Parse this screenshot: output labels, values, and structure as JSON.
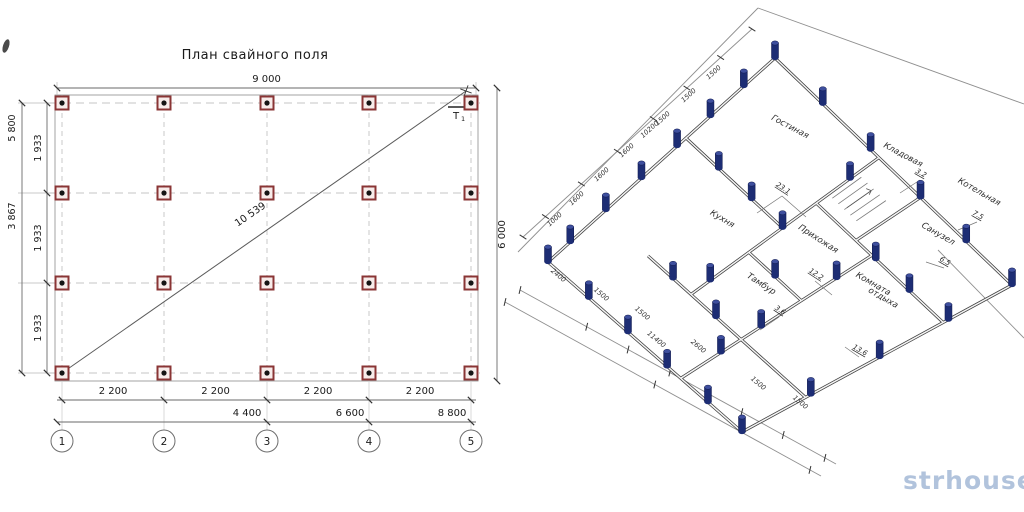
{
  "title": "План свайного поля",
  "watermark": "strhouse.ru",
  "colors": {
    "line": "#4a4a4a",
    "dim": "#6a6a6a",
    "text": "#1a1a1a",
    "dashed": "#c4c4c4",
    "thin": "#9a9a9a",
    "pile_red_border": "#8a3535",
    "pile_red_fill": "#f7ecea",
    "pile_dot": "#141414",
    "pile_navy": "#1d2d74",
    "pile_navy_top": "#3e4f9e",
    "watermark": "#a9bdd9"
  },
  "left": {
    "cols": [
      62,
      164,
      267,
      369,
      471
    ],
    "rows": [
      103,
      193,
      283,
      373
    ],
    "outline": [
      55,
      95,
      478,
      381
    ],
    "top_dim": {
      "y": 88,
      "x1": 57,
      "x2": 476,
      "label": "9 000"
    },
    "right_dim": {
      "x": 497,
      "y1": 88,
      "y2": 381,
      "label": "6 000"
    },
    "left_dim_outer": {
      "x": 22,
      "labels": [
        {
          "t": "5 800",
          "y": 128
        },
        {
          "t": "3 867",
          "y": 216
        }
      ]
    },
    "left_dim_inner": {
      "x": 47,
      "labels": [
        {
          "t": "1 933",
          "y": 148
        },
        {
          "t": "1 933",
          "y": 238
        },
        {
          "t": "1 933",
          "y": 328
        }
      ]
    },
    "diag": {
      "x1": 62,
      "y1": 373,
      "x2": 466,
      "y2": 91,
      "label": "10 539",
      "lx": 252,
      "ly": 217,
      "rot": -34.5
    },
    "bottom1": {
      "y": 400,
      "labels": [
        "2 200",
        "2 200",
        "2 200",
        "2 200"
      ]
    },
    "bottom2": {
      "y": 422,
      "ticks": [
        57,
        267,
        369,
        471
      ],
      "labels": [
        {
          "t": "4 400",
          "x": 247
        },
        {
          "t": "6 600",
          "x": 350
        },
        {
          "t": "8 800",
          "x": 452
        }
      ]
    },
    "axes": {
      "y": 441,
      "r": 11,
      "nums": [
        "1",
        "2",
        "3",
        "4",
        "5"
      ]
    },
    "t1_label": "Т1"
  },
  "right": {
    "corners": {
      "L": [
        548,
        262
      ],
      "T": [
        775,
        58
      ],
      "R": [
        1012,
        285
      ],
      "B": [
        742,
        432
      ]
    },
    "plan_size": [
      10200,
      11400
    ],
    "boundary": [
      [
        518,
        252,
        758,
        8
      ],
      [
        758,
        8,
        1024,
        104
      ],
      [
        938,
        250,
        1024,
        338
      ]
    ],
    "dim_lines": [
      [
        523,
        237,
        752,
        29
      ],
      [
        520,
        290,
        836,
        464
      ],
      [
        505,
        302,
        821,
        476
      ]
    ],
    "ticksA": [
      0,
      0.098,
      0.255,
      0.412,
      0.569,
      0.716,
      0.863,
      1
    ],
    "ticksB": [
      0,
      0.211,
      0.342,
      0.474,
      0.702,
      0.833,
      0.965
    ],
    "walls": [
      [
        0,
        0,
        10200,
        0
      ],
      [
        10200,
        0,
        10200,
        11400
      ],
      [
        10200,
        11400,
        0,
        11400
      ],
      [
        0,
        11400,
        0,
        0
      ],
      [
        6200,
        0,
        6200,
        5000
      ],
      [
        2400,
        5000,
        10200,
        5000
      ],
      [
        2400,
        2600,
        2400,
        7800
      ],
      [
        0,
        7800,
        7600,
        7800
      ],
      [
        7600,
        5000,
        7600,
        11400
      ],
      [
        7600,
        7000,
        10200,
        7000
      ],
      [
        4800,
        5000,
        4800,
        7800
      ],
      [
        2400,
        7800,
        2400,
        11400
      ]
    ],
    "piles": [
      [
        0,
        0
      ],
      [
        1000,
        0
      ],
      [
        2600,
        0
      ],
      [
        4200,
        0
      ],
      [
        5800,
        0
      ],
      [
        7300,
        0
      ],
      [
        8800,
        0
      ],
      [
        10200,
        0
      ],
      [
        10200,
        2300
      ],
      [
        10200,
        4600
      ],
      [
        10200,
        7000
      ],
      [
        10200,
        9200
      ],
      [
        10200,
        11400
      ],
      [
        7800,
        11400
      ],
      [
        5200,
        11400
      ],
      [
        2600,
        11400
      ],
      [
        0,
        11400
      ],
      [
        0,
        2400
      ],
      [
        0,
        4700
      ],
      [
        0,
        7000
      ],
      [
        0,
        9400
      ],
      [
        3200,
        5000
      ],
      [
        6200,
        5000
      ],
      [
        9000,
        5000
      ],
      [
        6200,
        1700
      ],
      [
        6200,
        3400
      ],
      [
        7600,
        8000
      ],
      [
        7600,
        9700
      ],
      [
        1600,
        7800
      ],
      [
        3200,
        7800
      ],
      [
        6200,
        7800
      ],
      [
        2400,
        4000
      ],
      [
        2400,
        6400
      ],
      [
        4800,
        6400
      ]
    ],
    "rooms": [
      {
        "t": "Гостиная",
        "x": 789,
        "y": 129,
        "r": 28
      },
      {
        "t": "Кладовая",
        "x": 902,
        "y": 157,
        "r": 28
      },
      {
        "t": "Котельная",
        "x": 978,
        "y": 194,
        "r": 30
      },
      {
        "t": "Кухня",
        "x": 721,
        "y": 221,
        "r": 31
      },
      {
        "t": "Прихожая",
        "x": 817,
        "y": 241,
        "r": 33
      },
      {
        "t": "Санузел",
        "x": 937,
        "y": 236,
        "r": 30
      },
      {
        "t": "Тамбур",
        "x": 760,
        "y": 286,
        "r": 33
      },
      {
        "t": "Комната",
        "x": 872,
        "y": 286,
        "r": 30
      },
      {
        "t": "отдыха",
        "x": 882,
        "y": 300,
        "r": 30
      }
    ],
    "areas": [
      {
        "t": "23.1",
        "x": 782,
        "y": 190,
        "r": 33
      },
      {
        "t": "3.2",
        "x": 920,
        "y": 175,
        "r": 30
      },
      {
        "t": "7.5",
        "x": 977,
        "y": 217,
        "r": 30
      },
      {
        "t": "6.5",
        "x": 944,
        "y": 263,
        "r": 30
      },
      {
        "t": "12.2",
        "x": 815,
        "y": 276,
        "r": 33
      },
      {
        "t": "3.6",
        "x": 779,
        "y": 312,
        "r": 33
      },
      {
        "t": "13.6",
        "x": 859,
        "y": 352,
        "r": 30
      }
    ],
    "leaders": [
      [
        782,
        196,
        757,
        213
      ],
      [
        782,
        196,
        806,
        217
      ],
      [
        815,
        281,
        832,
        295
      ],
      [
        920,
        180,
        900,
        193
      ],
      [
        977,
        222,
        958,
        230
      ],
      [
        944,
        268,
        926,
        262
      ],
      [
        859,
        357,
        845,
        347
      ],
      [
        779,
        317,
        760,
        330
      ]
    ],
    "dimsA": [
      {
        "t": "1000",
        "x": 556,
        "y": 221,
        "r": -42
      },
      {
        "t": "1600",
        "x": 578,
        "y": 200,
        "r": -42
      },
      {
        "t": "1600",
        "x": 603,
        "y": 176,
        "r": -42
      },
      {
        "t": "1600",
        "x": 628,
        "y": 152,
        "r": -42
      },
      {
        "t": "1500",
        "x": 664,
        "y": 120,
        "r": -42
      },
      {
        "t": "1500",
        "x": 690,
        "y": 97,
        "r": -42
      },
      {
        "t": "1500",
        "x": 715,
        "y": 74,
        "r": -42
      },
      {
        "t": "10200",
        "x": 651,
        "y": 131,
        "r": -42
      }
    ],
    "dimsB": [
      {
        "t": "2400",
        "x": 557,
        "y": 277,
        "r": 40
      },
      {
        "t": "1500",
        "x": 600,
        "y": 296,
        "r": 40
      },
      {
        "t": "1500",
        "x": 641,
        "y": 315,
        "r": 40
      },
      {
        "t": "11400",
        "x": 655,
        "y": 341,
        "r": 40
      },
      {
        "t": "2600",
        "x": 697,
        "y": 348,
        "r": 40
      },
      {
        "t": "1500",
        "x": 757,
        "y": 385,
        "r": 40
      },
      {
        "t": "1500",
        "x": 799,
        "y": 404,
        "r": 40
      }
    ],
    "stairs": {
      "a1": 8100,
      "b1": 5200,
      "a2": 9300,
      "b2": 6400,
      "steps": 5
    }
  }
}
